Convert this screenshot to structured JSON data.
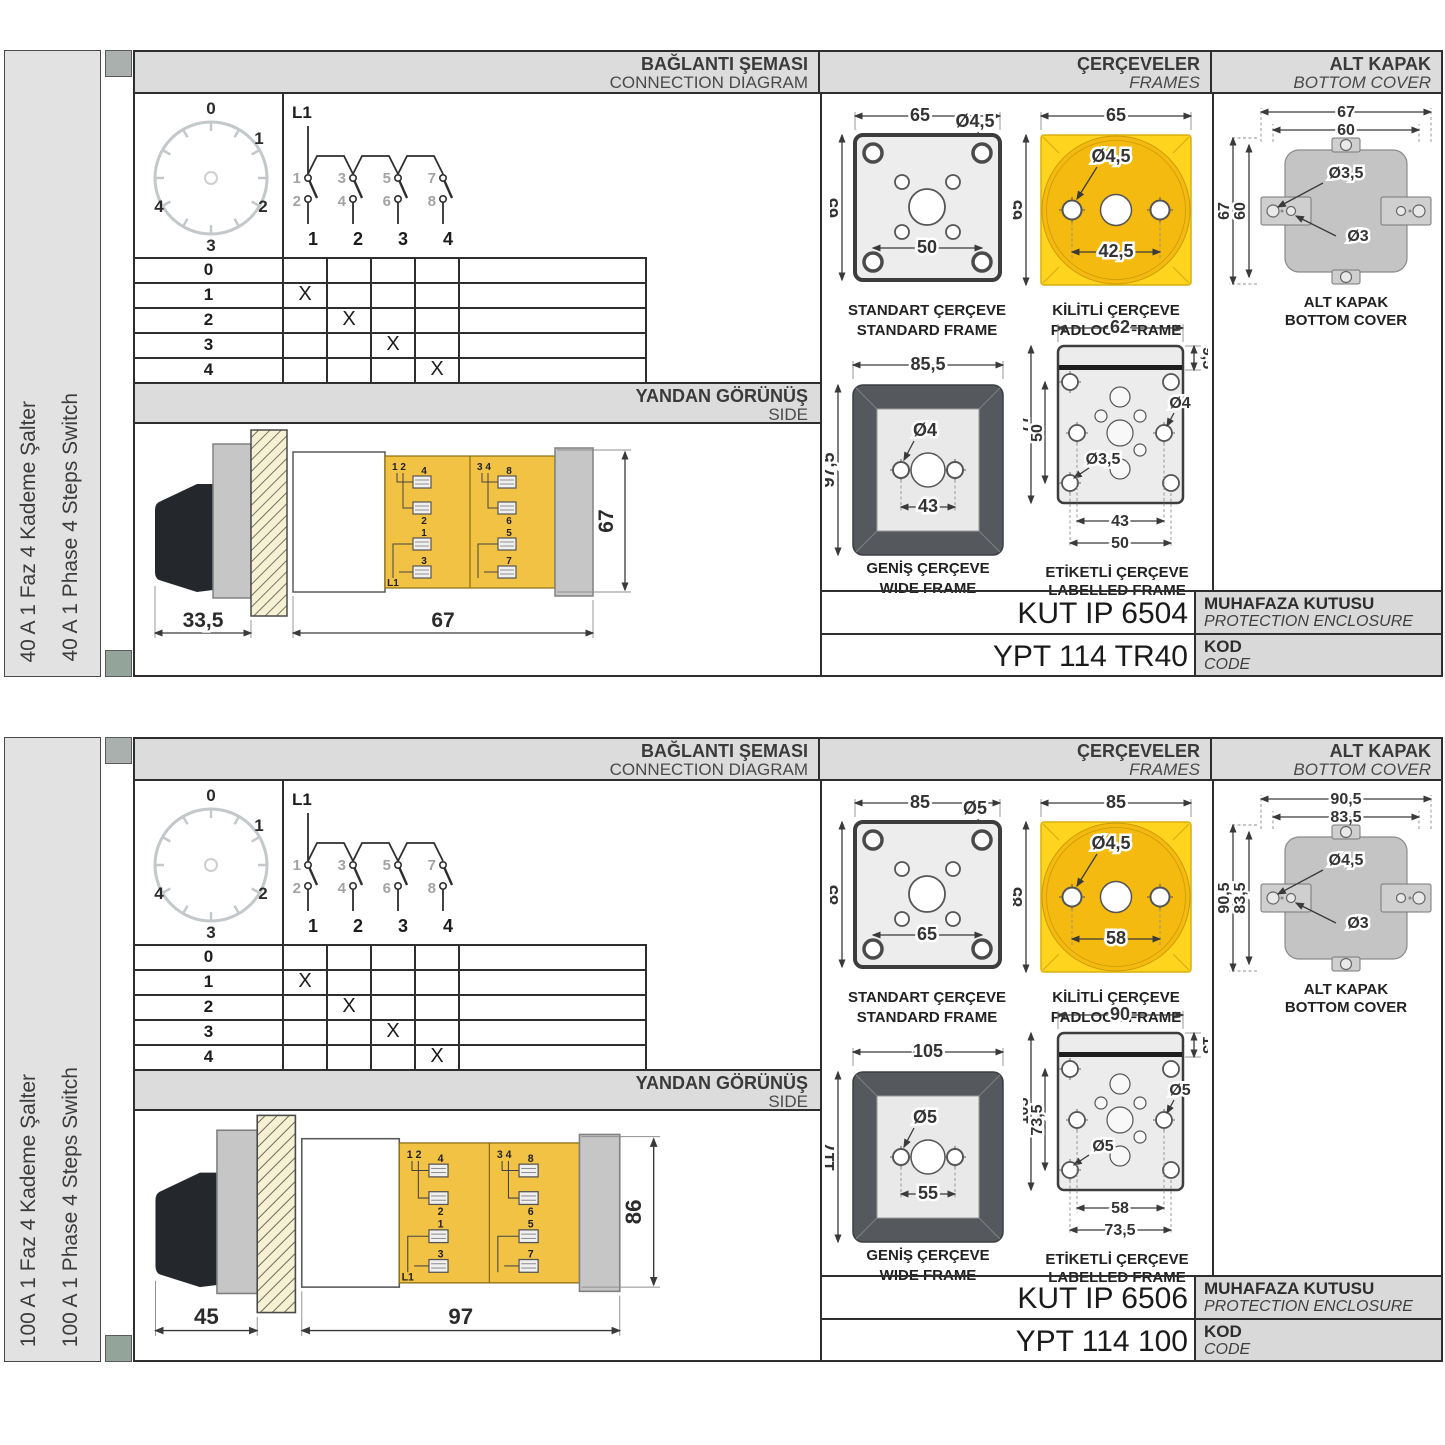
{
  "colors": {
    "frame_yellow": "#ffd41f",
    "padlock_circle": "#f4ba10",
    "switch_body_yellow": "#f2c244",
    "wide_frame_gray": "#55595e",
    "header_gray": "#dcdcdc",
    "cover_gray": "#c4c4c4"
  },
  "sections": [
    {
      "panel": {
        "label_tr": "40 A 1 Faz 4 Kademe Şalter",
        "label_en": "40 A 1 Phase 4 Steps Switch"
      },
      "headers": {
        "diagram_tr": "BAĞLANTI ŞEMASI",
        "diagram_en": "CONNECTION DIAGRAM",
        "frames_tr": "ÇERÇEVELER",
        "frames_en": "FRAMES",
        "cover_tr": "ALT KAPAK",
        "cover_en": "BOTTOM COVER"
      },
      "dial": {
        "p0": "0",
        "p1": "1",
        "p2": "2",
        "p3": "3",
        "p4": "4"
      },
      "circuit": {
        "phase": "L1",
        "t1": "1",
        "t3": "3",
        "t5": "5",
        "t7": "7",
        "b2": "2",
        "b4": "4",
        "b6": "6",
        "b8": "8",
        "p1": "1",
        "p2": "2",
        "p3": "3",
        "p4": "4"
      },
      "table": {
        "rows": [
          {
            "label": "0",
            "m": [
              "",
              "",
              "",
              ""
            ]
          },
          {
            "label": "1",
            "m": [
              "X",
              "",
              "",
              ""
            ]
          },
          {
            "label": "2",
            "m": [
              "",
              "X",
              "",
              ""
            ]
          },
          {
            "label": "3",
            "m": [
              "",
              "",
              "X",
              ""
            ]
          },
          {
            "label": "4",
            "m": [
              "",
              "",
              "",
              "X"
            ]
          }
        ]
      },
      "side": {
        "title_tr": "YANDAN GÖRÜNÜŞ",
        "title_en": "SIDE",
        "pair_left": "1 2",
        "pair_right": "3 4",
        "phase": "L1",
        "t": [
          "4",
          "2",
          "1",
          "3",
          "8",
          "6",
          "5",
          "7"
        ],
        "dim_depth": "33,5",
        "dim_length": "67",
        "dim_height": "67"
      },
      "frames": {
        "standard": {
          "cap_tr": "STANDART ÇERÇEVE",
          "cap_en": "STANDARD FRAME",
          "w": "65",
          "h": "65",
          "hole": "Ø4,5",
          "span": "50"
        },
        "padlock": {
          "cap_tr": "KİLİTLİ ÇERÇEVE",
          "cap_en": "PADLOCK FRAME",
          "w": "65",
          "h": "65",
          "hole": "Ø4,5",
          "span": "42,5"
        },
        "wide": {
          "cap_tr": "GENİŞ ÇERÇEVE",
          "cap_en": "WIDE FRAME",
          "w": "85,5",
          "h": "97,5",
          "hole": "Ø4",
          "span": "43"
        },
        "labelled": {
          "cap_tr": "ETİKETLİ ÇERÇEVE",
          "cap_en": "LABELLED FRAME",
          "w": "62",
          "strip": "9,5",
          "h": "77",
          "vspan": "50",
          "hole_a": "Ø4",
          "hole_b": "Ø3,5",
          "span_a": "43",
          "span_b": "50"
        }
      },
      "cover": {
        "cap_tr": "ALT KAPAK",
        "cap_en": "BOTTOM COVER",
        "w_outer": "67",
        "w_inner": "60",
        "h_outer": "67",
        "h_inner": "60",
        "hole_a": "Ø3,5",
        "hole_b": "Ø3"
      },
      "enclosure": {
        "value": "KUT IP 6504",
        "label_tr": "MUHAFAZA KUTUSU",
        "label_en": "PROTECTION ENCLOSURE"
      },
      "code": {
        "value": "YPT 114 TR40",
        "label_tr": "KOD",
        "label_en": "CODE"
      }
    },
    {
      "panel": {
        "label_tr": "100 A 1 Faz 4 Kademe Şalter",
        "label_en": "100 A 1 Phase 4 Steps Switch"
      },
      "headers": {
        "diagram_tr": "BAĞLANTI ŞEMASI",
        "diagram_en": "CONNECTION DIAGRAM",
        "frames_tr": "ÇERÇEVELER",
        "frames_en": "FRAMES",
        "cover_tr": "ALT KAPAK",
        "cover_en": "BOTTOM COVER"
      },
      "dial": {
        "p0": "0",
        "p1": "1",
        "p2": "2",
        "p3": "3",
        "p4": "4"
      },
      "circuit": {
        "phase": "L1",
        "t1": "1",
        "t3": "3",
        "t5": "5",
        "t7": "7",
        "b2": "2",
        "b4": "4",
        "b6": "6",
        "b8": "8",
        "p1": "1",
        "p2": "2",
        "p3": "3",
        "p4": "4"
      },
      "table": {
        "rows": [
          {
            "label": "0",
            "m": [
              "",
              "",
              "",
              ""
            ]
          },
          {
            "label": "1",
            "m": [
              "X",
              "",
              "",
              ""
            ]
          },
          {
            "label": "2",
            "m": [
              "",
              "X",
              "",
              ""
            ]
          },
          {
            "label": "3",
            "m": [
              "",
              "",
              "X",
              ""
            ]
          },
          {
            "label": "4",
            "m": [
              "",
              "",
              "",
              "X"
            ]
          }
        ]
      },
      "side": {
        "title_tr": "YANDAN GÖRÜNÜŞ",
        "title_en": "SIDE",
        "pair_left": "1 2",
        "pair_right": "3 4",
        "phase": "L1",
        "t": [
          "4",
          "2",
          "1",
          "3",
          "8",
          "6",
          "5",
          "7"
        ],
        "dim_depth": "45",
        "dim_length": "97",
        "dim_height": "86"
      },
      "frames": {
        "standard": {
          "cap_tr": "STANDART ÇERÇEVE",
          "cap_en": "STANDARD FRAME",
          "w": "85",
          "h": "85",
          "hole": "Ø5",
          "span": "65"
        },
        "padlock": {
          "cap_tr": "KİLİTLİ ÇERÇEVE",
          "cap_en": "PADLOCK FRAME",
          "w": "85",
          "h": "85",
          "hole": "Ø4,5",
          "span": "58"
        },
        "wide": {
          "cap_tr": "GENİŞ ÇERÇEVE",
          "cap_en": "WIDE FRAME",
          "w": "105",
          "h": "117",
          "hole": "Ø5",
          "span": "55"
        },
        "labelled": {
          "cap_tr": "ETİKETLİ ÇERÇEVE",
          "cap_en": "LABELLED FRAME",
          "w": "90",
          "strip": "13",
          "h": "105",
          "vspan": "73,5",
          "hole_a": "Ø5",
          "hole_b": "Ø5",
          "span_a": "58",
          "span_b": "73,5"
        }
      },
      "cover": {
        "cap_tr": "ALT KAPAK",
        "cap_en": "BOTTOM COVER",
        "w_outer": "90,5",
        "w_inner": "83,5",
        "h_outer": "90,5",
        "h_inner": "83,5",
        "hole_a": "Ø4,5",
        "hole_b": "Ø3"
      },
      "enclosure": {
        "value": "KUT IP 6506",
        "label_tr": "MUHAFAZA KUTUSU",
        "label_en": "PROTECTION ENCLOSURE"
      },
      "code": {
        "value": "YPT 114 100",
        "label_tr": "KOD",
        "label_en": "CODE"
      }
    }
  ]
}
